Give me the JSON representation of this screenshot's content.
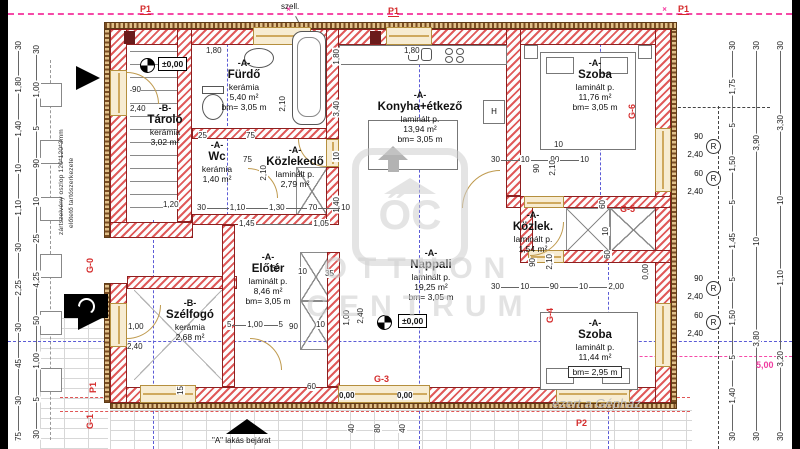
{
  "rooms": [
    {
      "id": "tarolo",
      "tag": "-B-",
      "name": "Tároló",
      "material": "kerámia",
      "area": "3,02 m²",
      "bm": ""
    },
    {
      "id": "furdo",
      "tag": "-A-",
      "name": "Fürdő",
      "material": "kerámia",
      "area": "5,40 m²",
      "bm": "bm= 3,05 m"
    },
    {
      "id": "wc",
      "tag": "-A-",
      "name": "Wc",
      "material": "kerámia",
      "area": "1,40 m²",
      "bm": ""
    },
    {
      "id": "kozlekedo",
      "tag": "-A-",
      "name": "Közlekedő",
      "material": "laminált p.",
      "area": "2,79 m²",
      "bm": ""
    },
    {
      "id": "konyha",
      "tag": "-A-",
      "name": "Konyha+étkező",
      "material": "laminált p.",
      "area": "13,94 m²",
      "bm": "bm= 3,05 m"
    },
    {
      "id": "szoba1",
      "tag": "-A-",
      "name": "Szoba",
      "material": "laminált p.",
      "area": "11,76 m²",
      "bm": "bm= 3,05 m"
    },
    {
      "id": "kozlek",
      "tag": "-A-",
      "name": "Közlek.",
      "material": "laminált p.",
      "area": "1,54 m²",
      "bm": ""
    },
    {
      "id": "eloter",
      "tag": "-A-",
      "name": "Előtér",
      "material": "laminált p.",
      "area": "8,46 m²",
      "bm": "bm= 3,05 m"
    },
    {
      "id": "nappali",
      "tag": "-A-",
      "name": "Nappali",
      "material": "laminált p.",
      "area": "19,25 m²",
      "bm": "bm= 3,05 m"
    },
    {
      "id": "szelfogo",
      "tag": "-B-",
      "name": "Szélfogó",
      "material": "kerámia",
      "area": "2,68 m²",
      "bm": ""
    },
    {
      "id": "szoba2",
      "tag": "-A-",
      "name": "Szoba",
      "material": "laminált p.",
      "area": "11,44 m²",
      "bm": "bm= 2,95 m"
    }
  ],
  "levels": {
    "main1": "±0,00",
    "main2": "±0,00",
    "t1": "0,00",
    "t2": "0,00"
  },
  "marks": {
    "p1a": "P1",
    "p1b": "P1",
    "p1c": "P1",
    "p1d": "P1",
    "p2": "P2",
    "g0": "G-0",
    "g1": "G-1",
    "g3": "G-3",
    "g4": "G-4",
    "g5": "G-5",
    "g6": "G-6",
    "r": "R",
    "vent": "szell.",
    "entrance": "\"A\" lakás bejárat",
    "magenta": "5,00",
    "fridge": "H"
  },
  "notes": {
    "column1": "zártszelvény oszlop 120*120*3mm",
    "column2": "előtető tartószerkezete"
  },
  "watermark": {
    "logo": "ŐC",
    "line1": "OTTHON",
    "line2": "CENTRUM",
    "bottom": "ezert a Gépház"
  },
  "dims": {
    "left_outer": [
      "30",
      "1,80",
      "1,40",
      "10",
      "1,10",
      "30",
      "2,25",
      "30",
      "45",
      "30",
      "75"
    ],
    "left_inner": [
      "30",
      "1,00",
      "5",
      "90",
      "10",
      "25",
      "4,25",
      "50",
      "1,00",
      "5",
      "30"
    ],
    "right_a": [
      "30",
      "1,75",
      "5",
      "1,50",
      "5",
      "1,45",
      "5",
      "1,50",
      "5",
      "1,40",
      "30"
    ],
    "right_b": [
      "30",
      "3,90",
      "10",
      "3,80",
      "30"
    ],
    "right_c": [
      "30",
      "3,30",
      "10",
      "1,10",
      "3,20",
      "30"
    ],
    "vmid": [
      "1,80",
      "3,40",
      "10",
      "1,40"
    ],
    "win_top": [
      "90",
      "2,40",
      "60",
      "2,40"
    ],
    "win_bot": [
      "90",
      "2,40",
      "60",
      "2,40"
    ],
    "row1": [
      "30",
      "1,10",
      "1,30",
      "70",
      "10"
    ],
    "row2": [
      "1,45",
      "1,05"
    ],
    "row3": [
      "30",
      "10",
      "90",
      "10"
    ],
    "row4": [
      "30",
      "10",
      "90",
      "10",
      "2,00"
    ],
    "row5": [
      "5",
      "1,00",
      "5"
    ],
    "s": {
      "a1": "1,80",
      "a2": "1,80",
      "b1": "25",
      "b2": "75",
      "b3": "75",
      "b4": "2,10",
      "b5": "2,10",
      "c3": "1,20",
      "d1": "60",
      "d2": "10",
      "d3": "35",
      "e2": "90",
      "e3": "10",
      "f1": "1,00",
      "f2": "2,40",
      "g1": "1,00",
      "g2": "2,40",
      "h2": "10",
      "h3": "90",
      "h4": "2,10",
      "i2": "90",
      "i3": "2,10",
      "i4": "60",
      "i5": "10",
      "i6": "60",
      "i7": "0,00",
      "j1": "90",
      "j2": "2,40",
      "k3": "60",
      "t1": "40",
      "t2": "80",
      "t3": "40",
      "t4": "15"
    }
  }
}
